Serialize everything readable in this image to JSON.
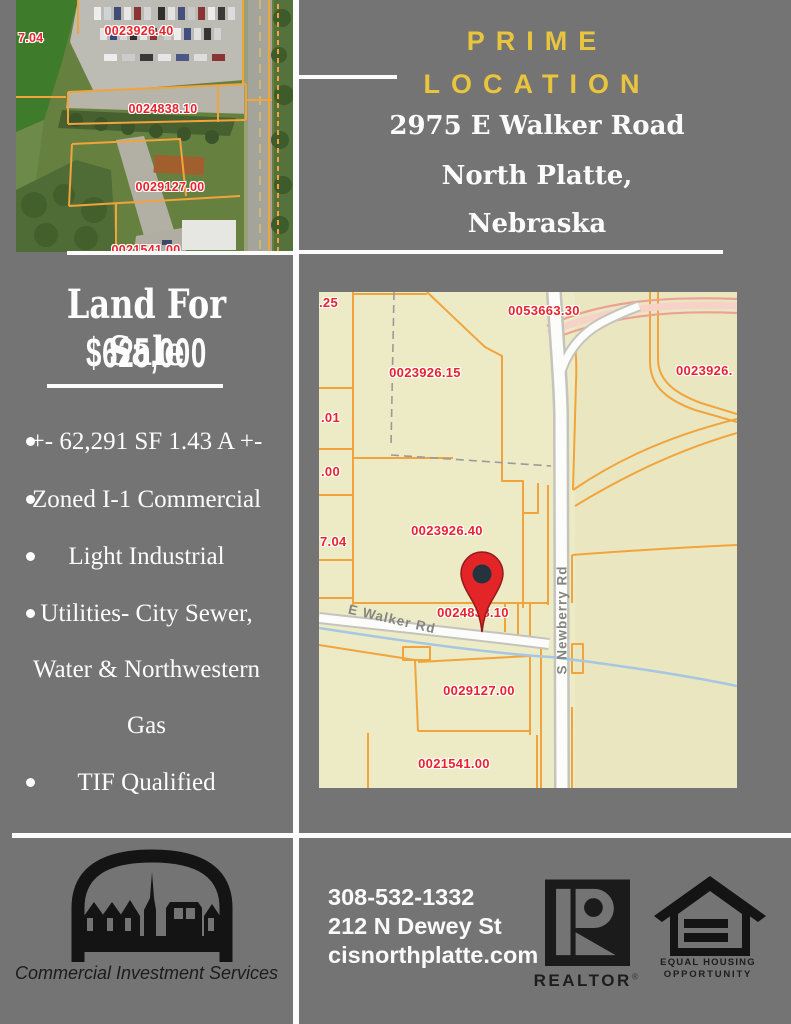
{
  "colors": {
    "background_gray": "#747474",
    "accent_yellow": "#e9c53e",
    "white": "#fbfbfb",
    "map_cream": "#edeac6",
    "parcel_orange": "#f2a43c",
    "parcel_label_red": "#e8232b",
    "pin_red": "#e42528",
    "stream_blue": "#a6c6e2",
    "logo_black": "#141414"
  },
  "aerial_map": {
    "labels": [
      "0023926.40",
      "0024838.10",
      "0029127.00",
      "7.04",
      "0021541.00"
    ]
  },
  "header": {
    "title_word1": "PRIME",
    "title_word2": "LOCATION",
    "address_line1": "2975 E Walker Road",
    "address_line2": "North Platte,",
    "address_line3": "Nebraska"
  },
  "listing": {
    "title": "Land For Sale",
    "price": "$625,000",
    "bullets": [
      {
        "has_bullet": true,
        "text": "+- 62,291 SF 1.43 A +-"
      },
      {
        "has_bullet": true,
        "text": "Zoned I-1 Commercial"
      },
      {
        "has_bullet": true,
        "text": "Light Industrial"
      },
      {
        "has_bullet": true,
        "text": "Utilities- City Sewer,"
      },
      {
        "has_bullet": false,
        "text": "Water & Northwestern"
      },
      {
        "has_bullet": false,
        "text": "Gas"
      },
      {
        "has_bullet": true,
        "text": "TIF Qualified"
      }
    ]
  },
  "plat_map": {
    "labels": [
      ".25",
      "0053663.30",
      "0023926.15",
      "0023926.",
      ".01",
      ".00",
      "7.04",
      "0023926.40",
      "0024838.10",
      "0029127.00",
      "0021541.00"
    ],
    "roads": [
      "E Walker Rd",
      "S Newberry Rd"
    ]
  },
  "footer": {
    "phone": "308-532-1332",
    "street": "212 N Dewey St",
    "website": "cisnorthplatte.com",
    "cis_caption": "Commercial Investment Services",
    "realtor_label": "REALTOR",
    "registered_mark": "®",
    "eho_line1": "EQUAL HOUSING",
    "eho_line2": "OPPORTUNITY"
  }
}
